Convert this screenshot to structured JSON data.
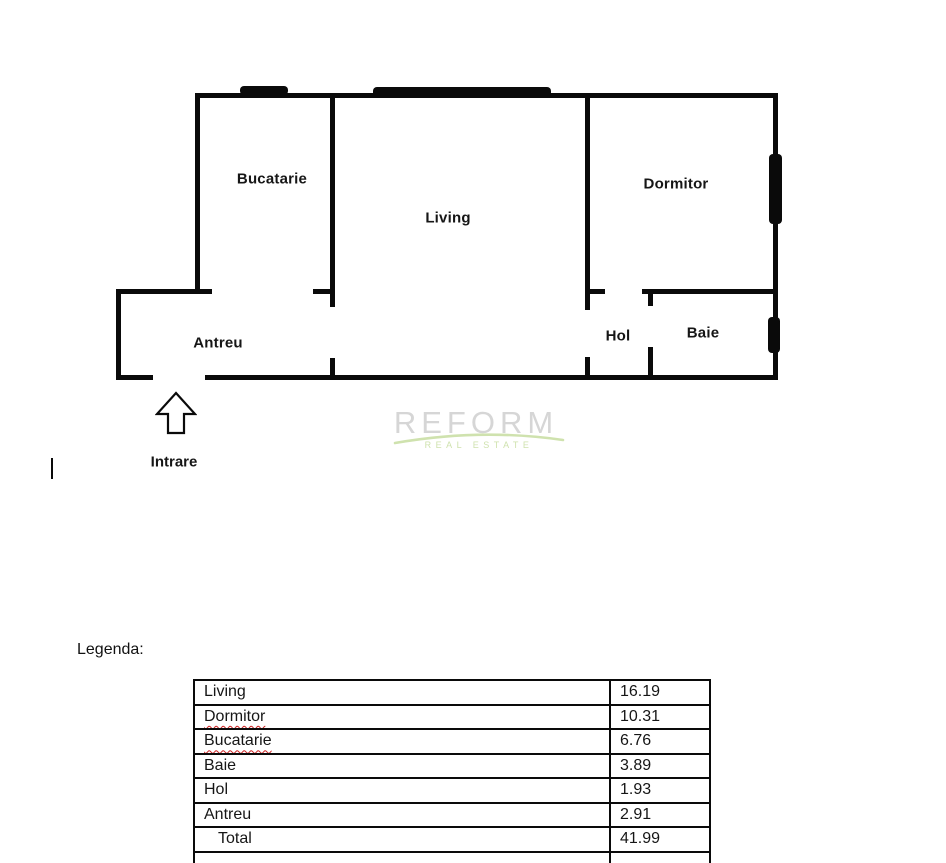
{
  "plan": {
    "rooms": {
      "bucatarie": "Bucatarie",
      "living": "Living",
      "dormitor": "Dormitor",
      "antreu": "Antreu",
      "hol": "Hol",
      "baie": "Baie"
    },
    "entrance_label": "Intrare"
  },
  "watermark": {
    "brand": "REFORM",
    "tagline": "REAL ESTATE",
    "brand_color": "#d6d6d6",
    "accent_color": "#cfe2ae"
  },
  "legend": {
    "title": "Legenda:",
    "rows": [
      {
        "label": "Living",
        "value": "16.19",
        "misspelled": false,
        "is_total": false
      },
      {
        "label": "Dormitor",
        "value": "10.31",
        "misspelled": true,
        "is_total": false
      },
      {
        "label": "Bucatarie",
        "value": "6.76",
        "misspelled": true,
        "is_total": false
      },
      {
        "label": "Baie",
        "value": "3.89",
        "misspelled": false,
        "is_total": false
      },
      {
        "label": "Hol",
        "value": "1.93",
        "misspelled": false,
        "is_total": false
      },
      {
        "label": "Antreu",
        "value": "2.91",
        "misspelled": false,
        "is_total": false
      },
      {
        "label": "Total",
        "value": "41.99",
        "misspelled": false,
        "is_total": true
      }
    ],
    "total": "41.99",
    "unit_note": ""
  }
}
